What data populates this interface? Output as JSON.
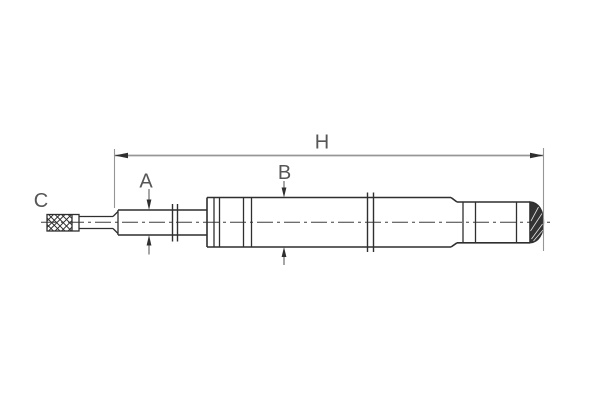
{
  "figure": {
    "labels": {
      "overall_length": "H",
      "rod_diameter": "A",
      "body_diameter": "B",
      "thread_end": "C"
    },
    "colors": {
      "background": "#ffffff",
      "outline": "#2f2f2f",
      "dimension_line": "#969696",
      "arrow": "#2f2f2f",
      "label_text": "#565656",
      "end_cap_fill": "#333333"
    }
  }
}
